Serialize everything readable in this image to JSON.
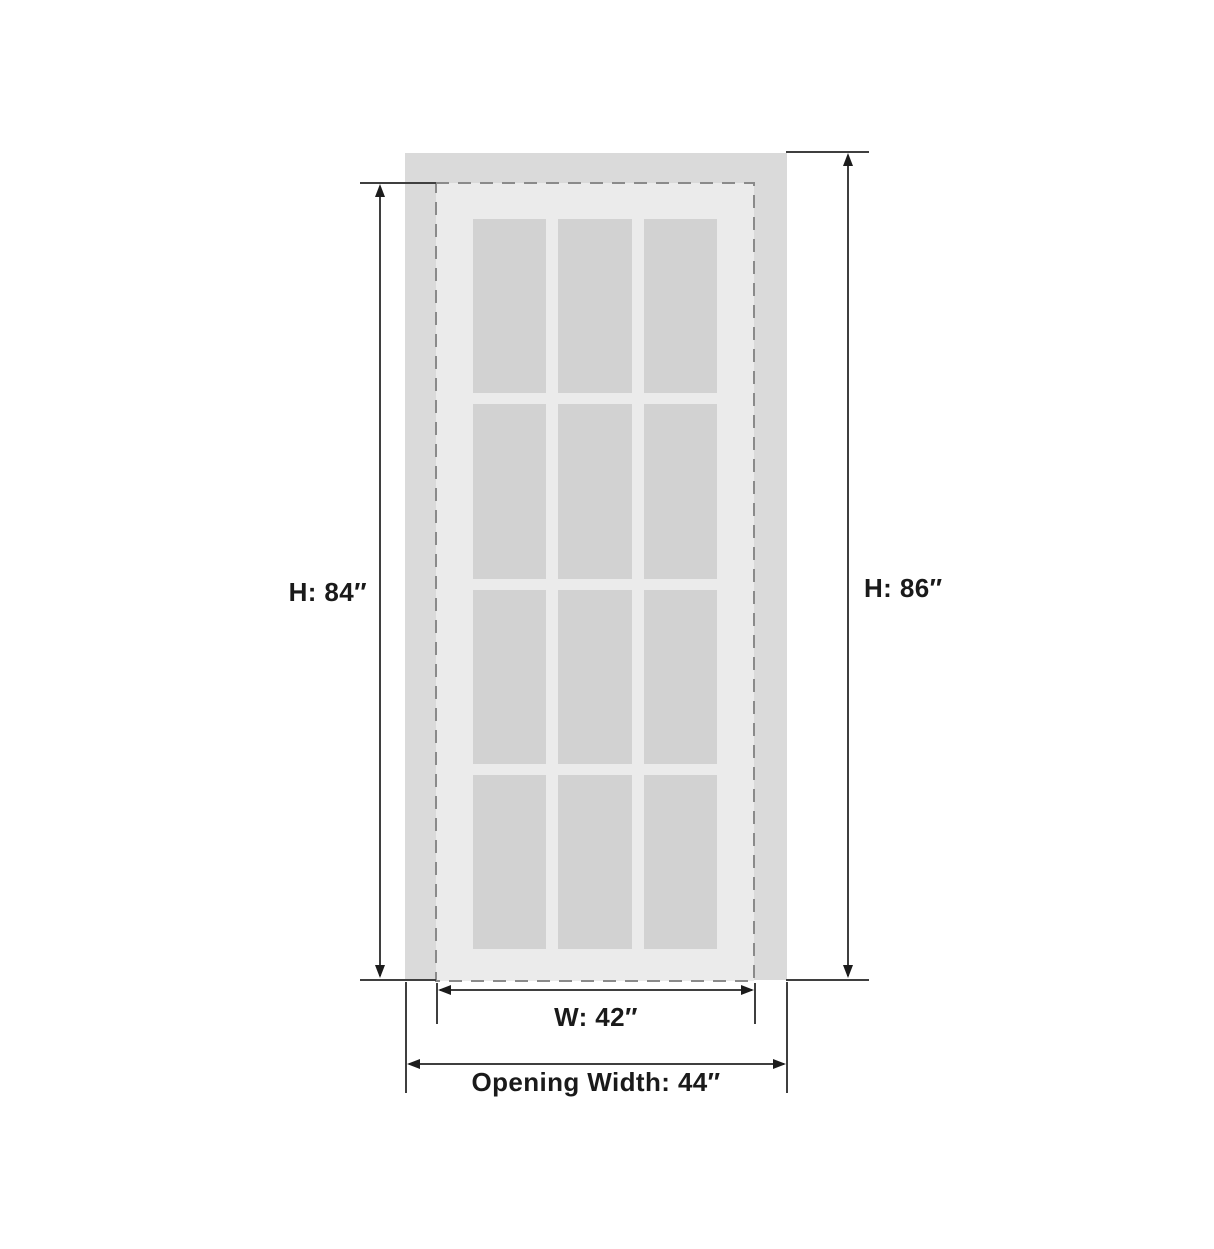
{
  "diagram": {
    "kind": "door-size-dimension-drawing",
    "door": {
      "panes": {
        "rows": 4,
        "columns": 3,
        "count": 12
      }
    },
    "dimensions": {
      "door_height": {
        "label": "H: 84″",
        "value": 84,
        "unit": "inches"
      },
      "opening_height": {
        "label": "H: 86″",
        "value": 86,
        "unit": "inches"
      },
      "door_width": {
        "label": "W: 42″",
        "value": 42,
        "unit": "inches"
      },
      "opening_width": {
        "label": "Opening Width: 44″",
        "value": 44,
        "unit": "inches"
      }
    },
    "colors": {
      "opening_fill": "#dadada",
      "door_face_fill": "#ebebeb",
      "pane_fill": "#d2d2d2",
      "outline_dash": "#8a8a8a",
      "dim_line": "#3f3f3f",
      "arrow": "#1c1c1c",
      "label_text": "#1a1a1a",
      "bg": "#ffffff"
    }
  }
}
